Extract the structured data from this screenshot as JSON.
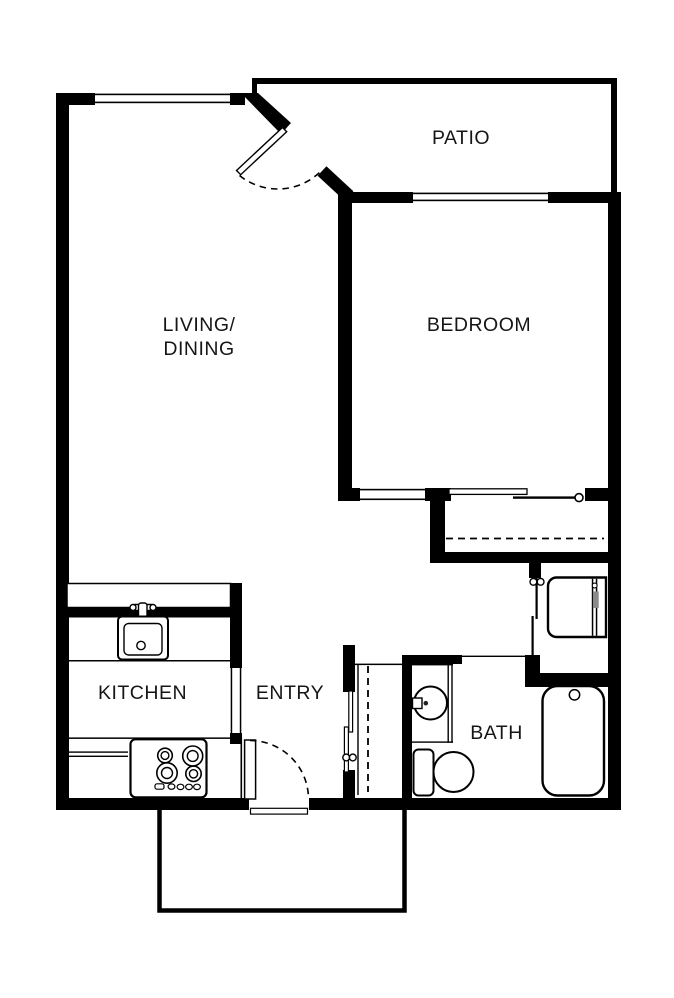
{
  "plan": {
    "title": "One-bedroom apartment floor plan",
    "labels": {
      "living_line1": "LIVING/",
      "living_line2": "DINING",
      "bedroom": "BEDROOM",
      "patio": "PATIO",
      "kitchen": "KITCHEN",
      "entry": "ENTRY",
      "bath": "BATH"
    },
    "rooms": [
      {
        "id": "living_dining",
        "label": "LIVING/ DINING"
      },
      {
        "id": "bedroom",
        "label": "BEDROOM"
      },
      {
        "id": "patio",
        "label": "PATIO"
      },
      {
        "id": "kitchen",
        "label": "KITCHEN"
      },
      {
        "id": "entry",
        "label": "ENTRY"
      },
      {
        "id": "bath",
        "label": "BATH"
      }
    ],
    "fixtures": [
      "kitchen-sink",
      "range-stove",
      "breakfast-bar",
      "kitchen-counter",
      "bathroom-sink",
      "toilet",
      "bathtub",
      "washer-dryer-unit",
      "bedroom-closet-rod",
      "entry-closet-rod",
      "bypass-sliding-doors",
      "utility-closet-doors",
      "front-door",
      "corner-patio-door",
      "living-window",
      "bedroom-window",
      "entry-porch"
    ],
    "colors": {
      "walls": "#000000",
      "background": "#ffffff",
      "text": "#161616",
      "appliance_accent": "#8a8a8a"
    }
  }
}
